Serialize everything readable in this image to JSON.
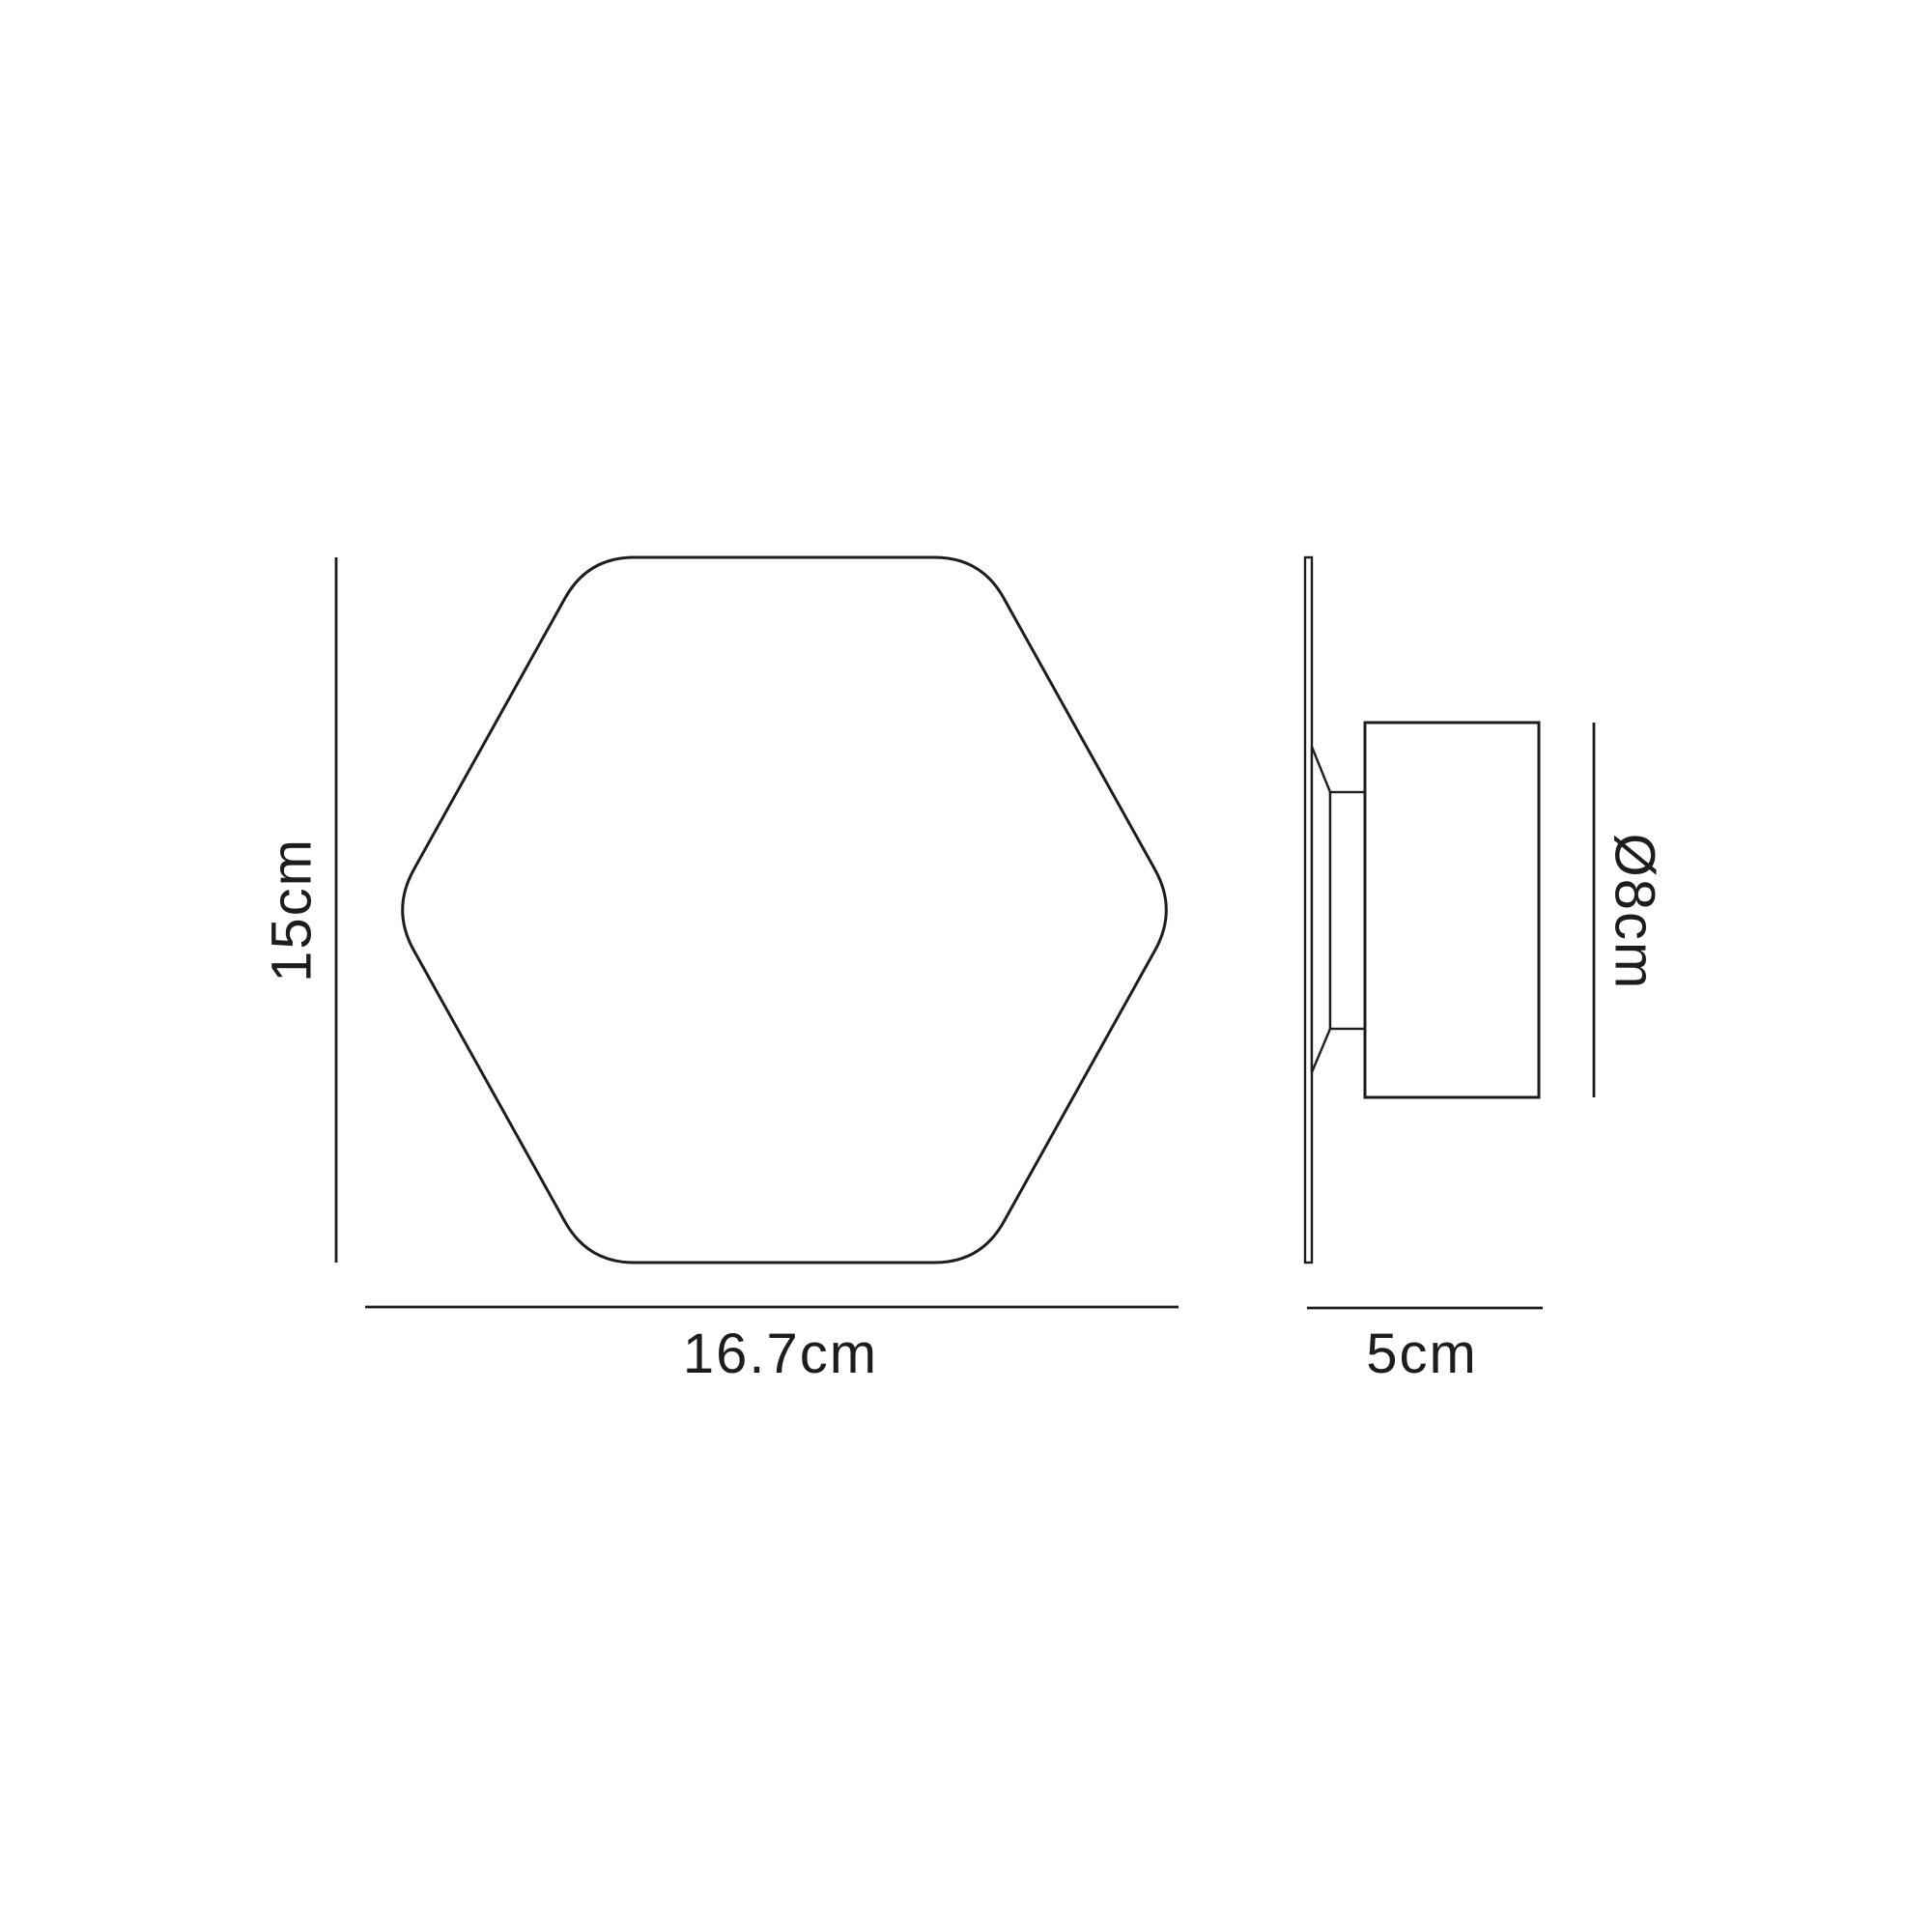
{
  "colors": {
    "background": "#ffffff",
    "line": "#1d1d1b",
    "text": "#1d1d1b"
  },
  "front_view": {
    "height_label": "15cm",
    "width_label": "16.7cm"
  },
  "side_view": {
    "diameter_label": "Ø8cm",
    "depth_label": "5cm"
  }
}
